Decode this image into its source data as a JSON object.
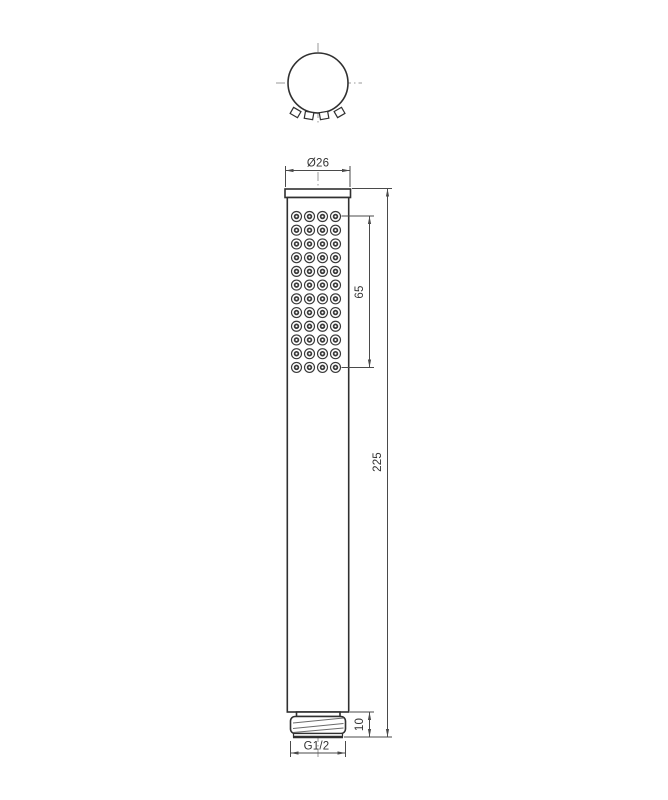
{
  "drawing": {
    "type": "technical-drawing",
    "description": "Handheld shower head, two-view dimensioned drawing",
    "views": {
      "top_view": "top view",
      "front_view": "front view"
    },
    "dimensions": {
      "diameter": "Ø26",
      "spray_face_length": "65",
      "overall_length": "225",
      "connector_length": "10",
      "thread_size": "G1/2"
    },
    "nozzle_grid": {
      "rows": 12,
      "columns": 4,
      "col_start_x": 296.5,
      "col_step": 13,
      "row_start_y": 216.5,
      "row_step": 13.72,
      "outer_radius": 5,
      "inner_radius": 1.9
    },
    "colors": {
      "background": "#ffffff",
      "object_line": "#303030",
      "dimension_line": "#4a4a4a",
      "centerline": "#9a9a9a",
      "text": "#333333"
    }
  }
}
